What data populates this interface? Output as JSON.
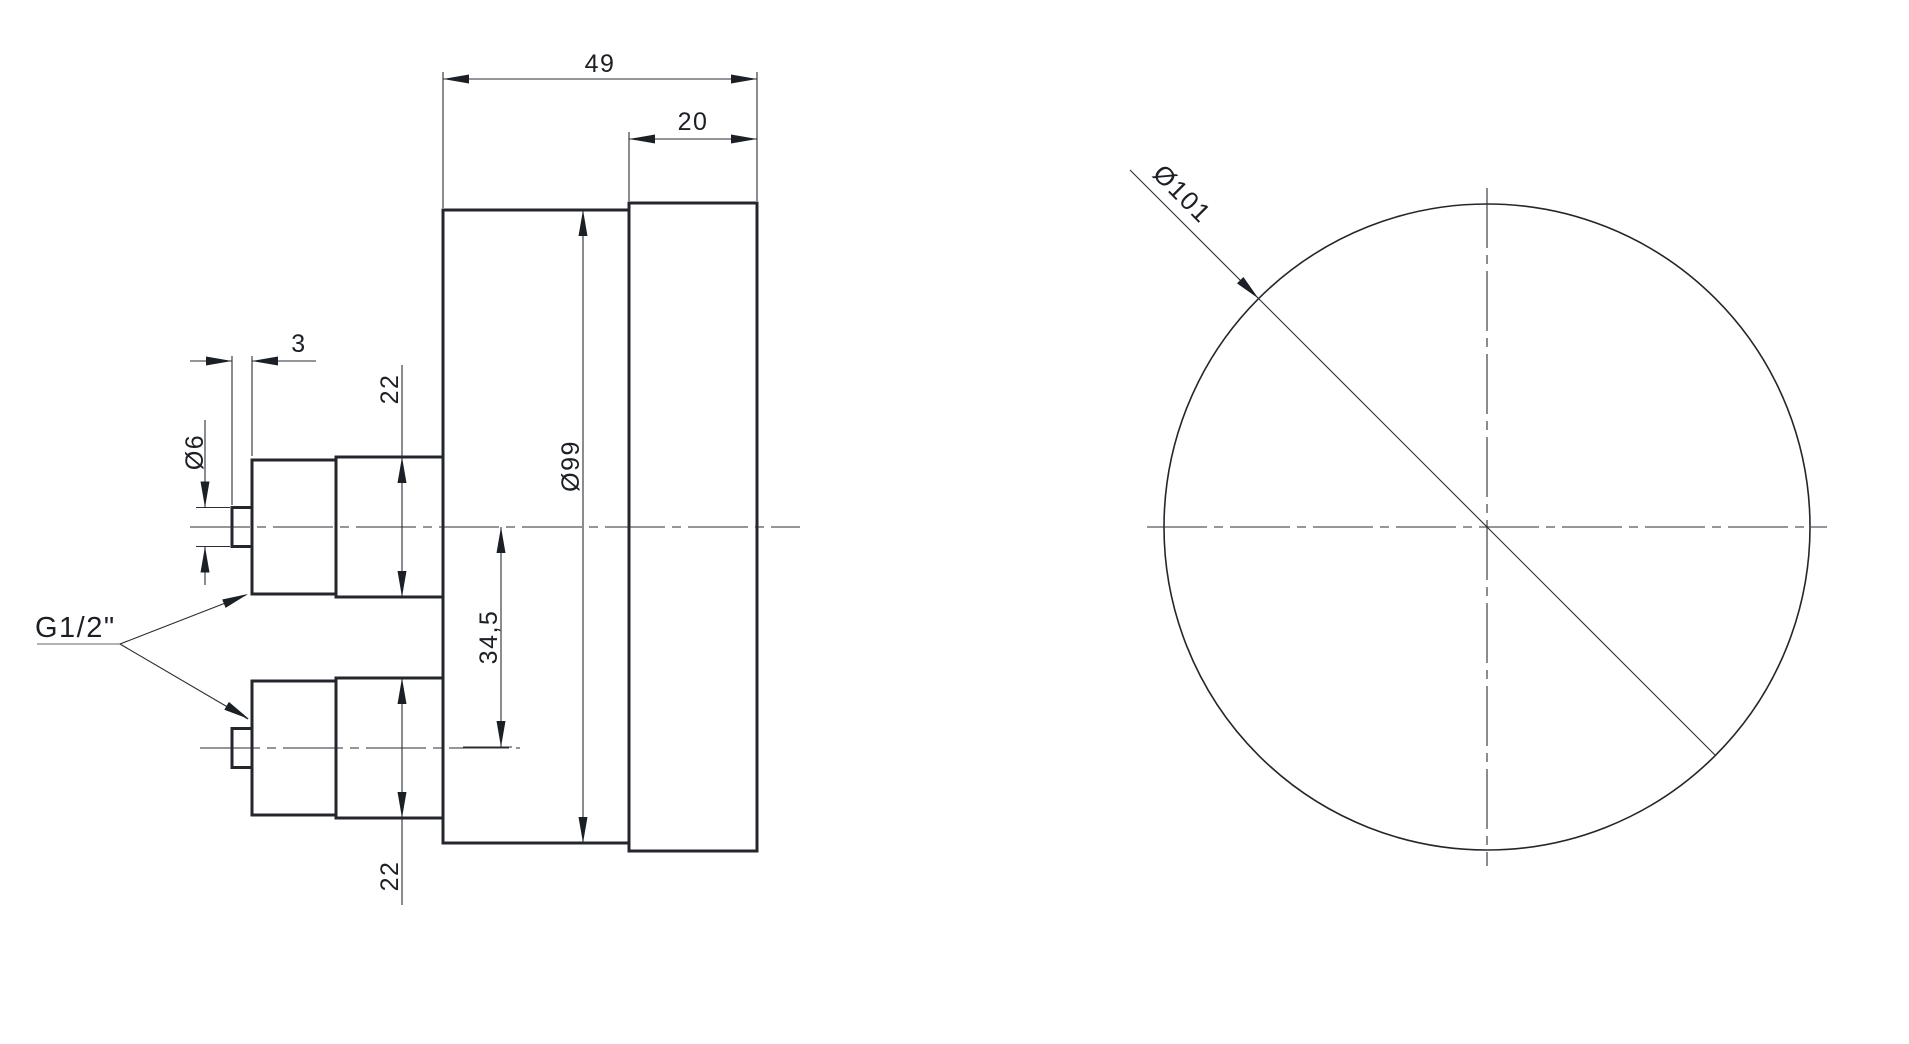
{
  "page": {
    "background": "#ffffff",
    "description": "technical drawing, pressure gauge with two rear process connections, side view and front view"
  },
  "drawing": {
    "line_color": "#23272d",
    "text_color": "#1b1f26",
    "dimensions": {
      "total_depth": "49",
      "bezel_depth": "20",
      "stub_length": "3",
      "stub_diameter": "Ø6",
      "upper_connection_size": "22",
      "case_diameter": "Ø99",
      "connection_offset": "34,5",
      "lower_connection_size": "22",
      "thread": "G1/2\"",
      "front_diameter": "Ø101"
    }
  }
}
